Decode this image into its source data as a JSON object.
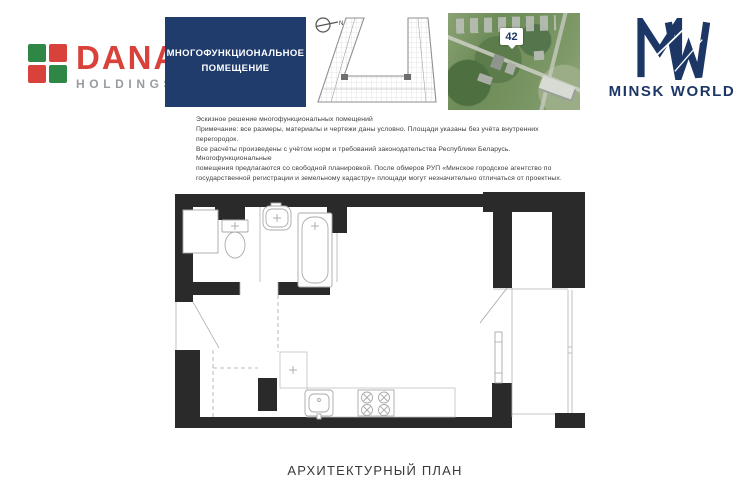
{
  "dana": {
    "name": "DANA",
    "subtitle": "HOLDINGS"
  },
  "title_box": {
    "line1": "МНОГОФУНКЦИОНАЛЬНОЕ",
    "line2": "ПОМЕЩЕНИЕ"
  },
  "site_key": {
    "north_label": "N"
  },
  "aerial": {
    "marker": "42"
  },
  "minsk": {
    "brand": "MINSK WORLD"
  },
  "disclaimer": {
    "lines": [
      "Эскизное решение многофункциональных помещений",
      "Примечание: все размеры, материалы и чертежи даны условно. Площади указаны без учёта внутренних перегородок.",
      "Все расчёты произведены с учётом норм и требований законодательства Республики Беларусь. Многофункциональные",
      "помещения предлагаются со свободной планировкой. После обмеров РУП «Минское городское агентство по",
      "государственной регистрации и земельному кадастру» площади могут незначительно отличаться от проектных."
    ]
  },
  "page": {
    "caption": "АРХИТЕКТУРНЫЙ ПЛАН"
  },
  "colors": {
    "dana_green": "#2f8746",
    "dana_red": "#d8423b",
    "title_box_bg": "#1f3c6c",
    "minsk_navy": "#1c3766",
    "wall_black": "#2a2a2a"
  }
}
